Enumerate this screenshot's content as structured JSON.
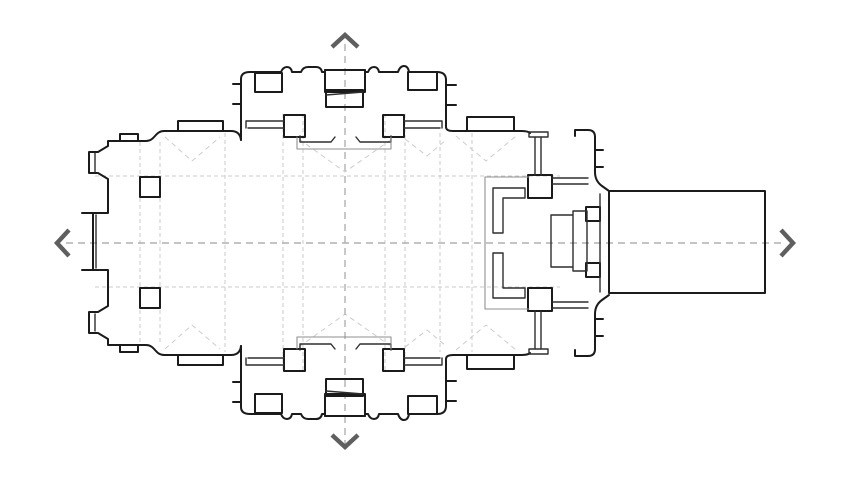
{
  "figure": {
    "kind": "architectural-floor-plan",
    "subject": "cruciform church plan with transepts, crossing piers, choir and eastern annex",
    "background": "#ffffff"
  },
  "canvas": {
    "width_px": 847,
    "height_px": 495
  },
  "colors": {
    "outline": "#1b1b1b",
    "detail": "#2e2e2e",
    "thin_gray": "#8f8f8f",
    "axis_line": "#b0b0b0",
    "arrow": "#5f5f5f",
    "grid_line": "#cbcbcb",
    "vault_line": "#cccccc"
  },
  "axis_arrows": [
    {
      "id": "up",
      "icon": "chevron-up-icon"
    },
    {
      "id": "down",
      "icon": "chevron-down-icon"
    },
    {
      "id": "left",
      "icon": "chevron-left-icon"
    },
    {
      "id": "right",
      "icon": "chevron-right-icon"
    }
  ],
  "plan_elements": [
    "west-front-block",
    "west-entrance-projection",
    "west-interior-piers",
    "nave-north-wall",
    "nave-south-wall",
    "north-wall-chapel-projection",
    "south-wall-chapel-projection",
    "north-transept",
    "south-transept",
    "transept-chapel-niches",
    "crossing-piers",
    "transept-screen-platforms",
    "choir-enclosure",
    "choir-stalls",
    "altar-platform",
    "apse-north-wall",
    "apse-south-wall",
    "apse-buttresses",
    "eastern-annex-hall",
    "axis-center-lines",
    "bay-grid-lines",
    "vault-diagonals"
  ]
}
